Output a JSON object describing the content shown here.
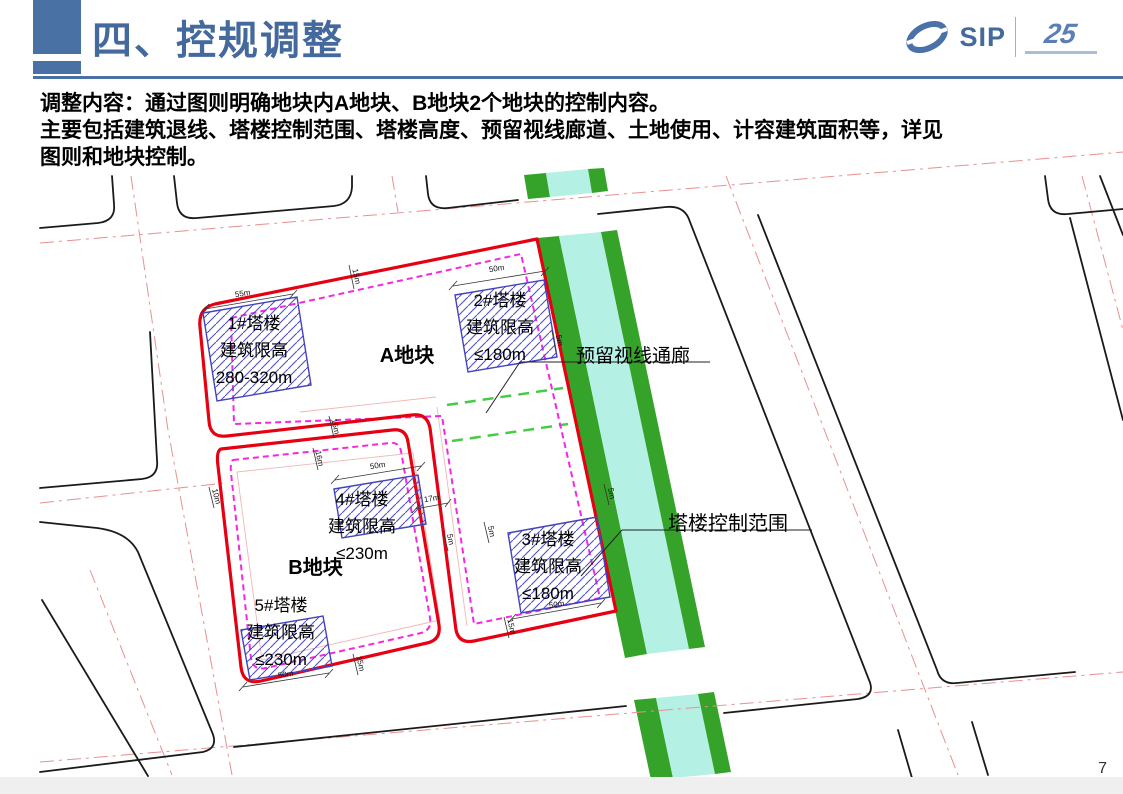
{
  "slide": {
    "title": "四、控规调整",
    "page_number": "7"
  },
  "logo": {
    "sip": "SIP",
    "anniversary": "25"
  },
  "body": {
    "line1": "调整内容：通过图则明确地块内A地块、B地块2个地块的控制内容。",
    "line2": "主要包括建筑退线、塔楼控制范围、塔楼高度、预留视线廊道、土地使用、计容建筑面积等，详见",
    "line3": "图则和地块控制。"
  },
  "map": {
    "plots": [
      {
        "name": "A地块"
      },
      {
        "name": "B地块"
      }
    ],
    "towers": [
      {
        "id": "tower-1",
        "lines": [
          "1#塔楼",
          "建筑限高",
          "280-320m"
        ]
      },
      {
        "id": "tower-2",
        "lines": [
          "2#塔楼",
          "建筑限高",
          "≤180m"
        ]
      },
      {
        "id": "tower-3",
        "lines": [
          "3#塔楼",
          "建筑限高",
          "≤180m"
        ]
      },
      {
        "id": "tower-4",
        "lines": [
          "4#塔楼",
          "建筑限高",
          "≤230m"
        ]
      },
      {
        "id": "tower-5",
        "lines": [
          "5#塔楼",
          "建筑限高",
          "≤230m"
        ]
      }
    ],
    "annotations": {
      "sight_corridor": "预留视线通廊",
      "tower_control": "塔楼控制范围"
    },
    "dims": [
      {
        "label": "55m"
      },
      {
        "label": "15m"
      },
      {
        "label": "50m"
      },
      {
        "label": "5m"
      },
      {
        "label": "16m"
      },
      {
        "label": "16m"
      },
      {
        "label": "10m"
      },
      {
        "label": "50m"
      },
      {
        "label": "17m"
      },
      {
        "label": "5m"
      },
      {
        "label": "5m"
      },
      {
        "label": "5m"
      },
      {
        "label": "50m"
      },
      {
        "label": "15m"
      },
      {
        "label": "50m"
      },
      {
        "label": "15m"
      }
    ]
  },
  "colors": {
    "accent_blue": "#4a71a3",
    "plot_red": "#e60012",
    "setback_magenta": "#f428e0",
    "water_cyan": "#b4f0e4",
    "bank_green": "#35a32a",
    "corridor_green": "#44cc44",
    "hatch_blue": "#4646c8",
    "centerline_pink": "#e89090"
  }
}
